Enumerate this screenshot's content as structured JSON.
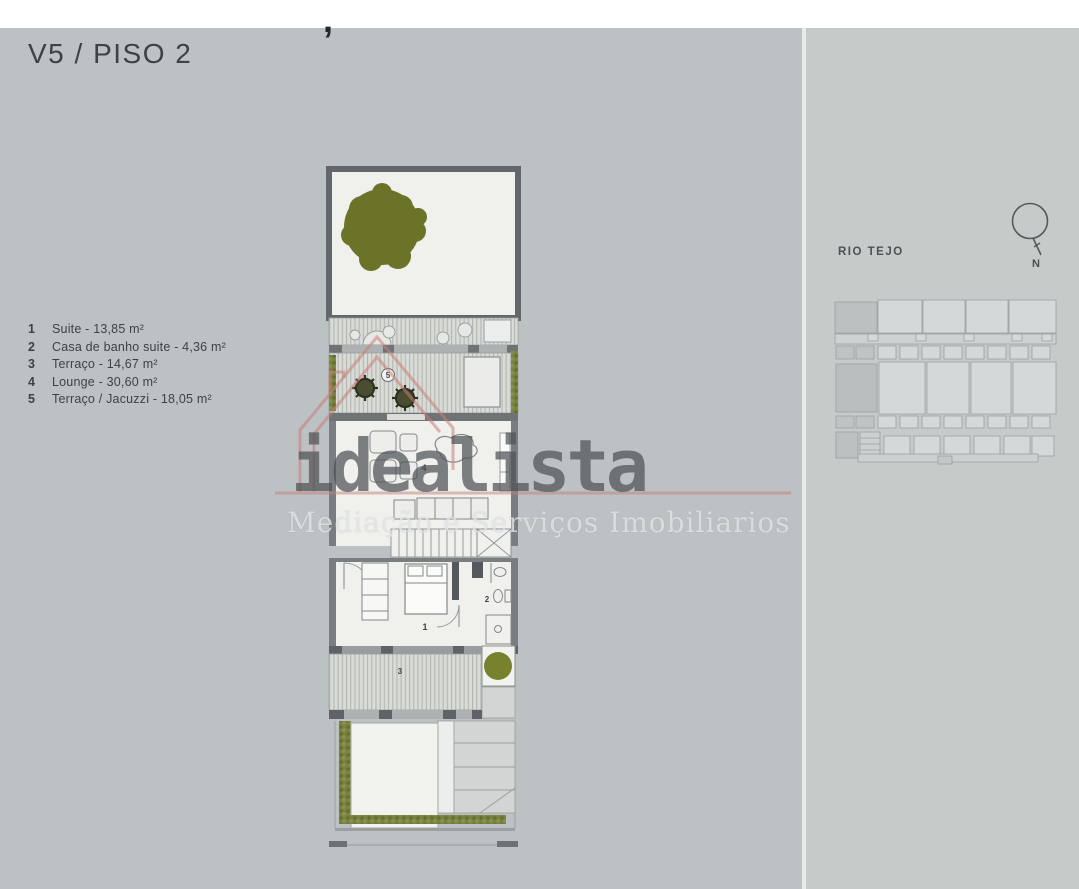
{
  "page": {
    "stray_mark": ",",
    "title": "V5 / PISO 2"
  },
  "legend": {
    "items": [
      {
        "num": "1",
        "label": "Suite - 13,85 m²"
      },
      {
        "num": "2",
        "label": "Casa de banho suite - 4,36 m²"
      },
      {
        "num": "3",
        "label": "Terraço - 14,67 m²"
      },
      {
        "num": "4",
        "label": "Lounge - 30,60 m²"
      },
      {
        "num": "5",
        "label": "Terraço / Jacuzzi - 18,05 m²"
      }
    ]
  },
  "floor_plan": {
    "rooms": {
      "suite": "1",
      "bathroom": "2",
      "terrace": "3",
      "lounge": "4",
      "jacuzzi_terrace": "5"
    }
  },
  "watermark": {
    "brand": "idealista",
    "tagline": "Mediação e Serviços Imobiliarios"
  },
  "site": {
    "river_label": "RIO TEJO",
    "north_label": "N"
  },
  "colors": {
    "background": "#bcc1c3",
    "right_panel": "#c6cac9",
    "tree_green": "#6b7328",
    "plant_green": "#77812e",
    "hedge_green": "#79823f",
    "watermark_red": "#c67d78",
    "wall_dark": "#5f6367",
    "plan_interior": "#f0f0ed"
  }
}
